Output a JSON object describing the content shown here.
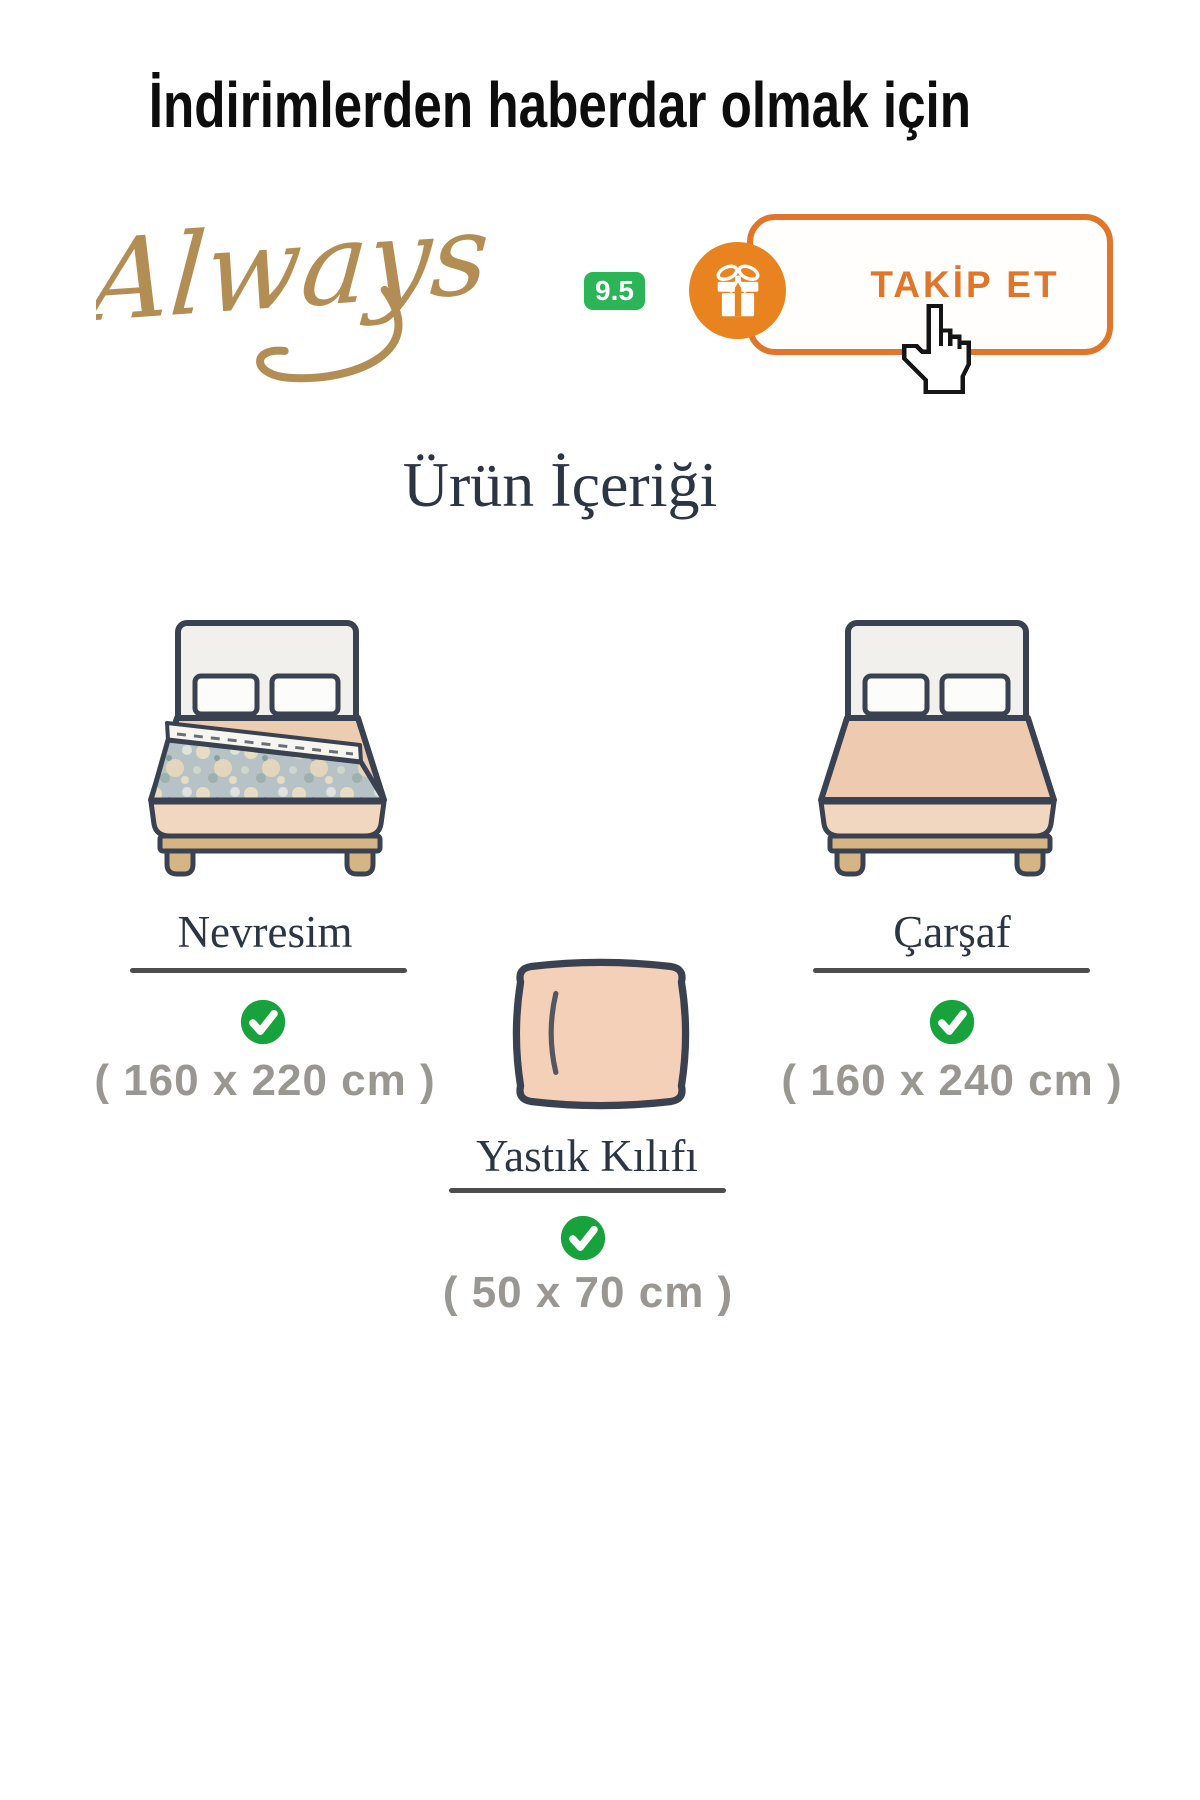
{
  "header": {
    "text": "İndirimlerden haberdar olmak için"
  },
  "brand": {
    "name": "Always",
    "rating": "9.5",
    "follow_button": "TAKİP ET"
  },
  "section": {
    "title": "Ürün İçeriği"
  },
  "items": [
    {
      "name": "Nevresim",
      "size": "( 160 x 220 cm )",
      "included": true
    },
    {
      "name": "Çarşaf",
      "size": "( 160 x 240 cm )",
      "included": true
    },
    {
      "name": "Yastık Kılıfı",
      "size": "( 50 x 70 cm )",
      "included": true
    }
  ],
  "colors": {
    "accent_orange": "#e0762a",
    "gift_orange": "#e8831f",
    "rating_green": "#2bb556",
    "check_green": "#17a23c",
    "brand_gold": "#b28e55",
    "heading_navy": "#2c3544",
    "size_gray": "#9a9691",
    "outline_navy": "#3a4150"
  }
}
